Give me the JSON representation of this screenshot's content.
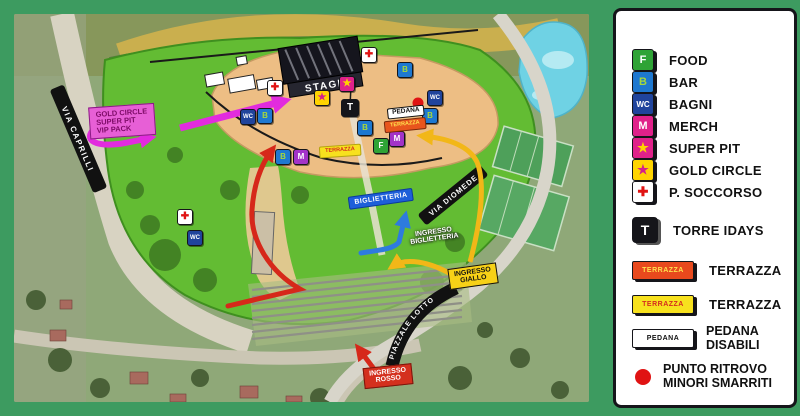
{
  "legend": {
    "items": [
      {
        "glyph": "F",
        "label": "FOOD"
      },
      {
        "glyph": "B",
        "label": "BAR"
      },
      {
        "glyph": "WC",
        "label": "BAGNI"
      },
      {
        "glyph": "M",
        "label": "MERCH"
      },
      {
        "glyph": "★",
        "label": "SUPER PIT"
      },
      {
        "glyph": "★",
        "label": "GOLD CIRCLE"
      },
      {
        "glyph": "✚",
        "label": "P. SOCCORSO"
      }
    ],
    "torre": {
      "glyph": "T",
      "label": "TORRE IDAYS"
    },
    "terrazza_red": {
      "box": "TERRAZZA",
      "label": "TERRAZZA"
    },
    "terrazza_yellow": {
      "box": "TERRAZZA",
      "label": "TERRAZZA"
    },
    "pedana": {
      "box": "PEDANA",
      "label_line1": "PEDANA",
      "label_line2": "DISABILI"
    },
    "punto": {
      "label_line1": "PUNTO RITROVO",
      "label_line2": "MINORI SMARRITI"
    }
  },
  "map": {
    "streets": {
      "caprilli": "VIA CAPRILLI",
      "diomede": "VIA DIOMEDE",
      "lotto": "PIAZZALE LOTTO"
    },
    "stage": "STAGE",
    "gold_callout": {
      "line1": "GOLD CIRCLE",
      "line2": "SUPER PIT",
      "line3": "VIP PACK"
    },
    "labels": {
      "biglietteria": "BIGLIETTERIA",
      "ingresso_biglietteria_1": "INGRESSO",
      "ingresso_biglietteria_2": "BIGLIETTERIA",
      "ingresso_giallo_1": "INGRESSO",
      "ingresso_giallo_2": "GIALLO",
      "ingresso_rosso_1": "INGRESSO",
      "ingresso_rosso_2": "ROSSO",
      "terrazza": "TERRAZZA",
      "pedana": "PEDANA"
    },
    "icon_glyphs": {
      "f": "F",
      "b": "B",
      "wc": "WC",
      "m": "M",
      "t": "T",
      "star": "★",
      "cross": "✚"
    }
  },
  "colors": {
    "frame": "#3D9B60",
    "food": "#2FA336",
    "bar": "#1E78D0",
    "bagni": "#20449C",
    "merch": "#E0218A",
    "gold": "#FFD400",
    "soccorso": "#E01313",
    "route_red": "#D6281A",
    "route_blue": "#2E7BDE",
    "route_yellow": "#F2B718",
    "route_magenta": "#E22BDE"
  }
}
